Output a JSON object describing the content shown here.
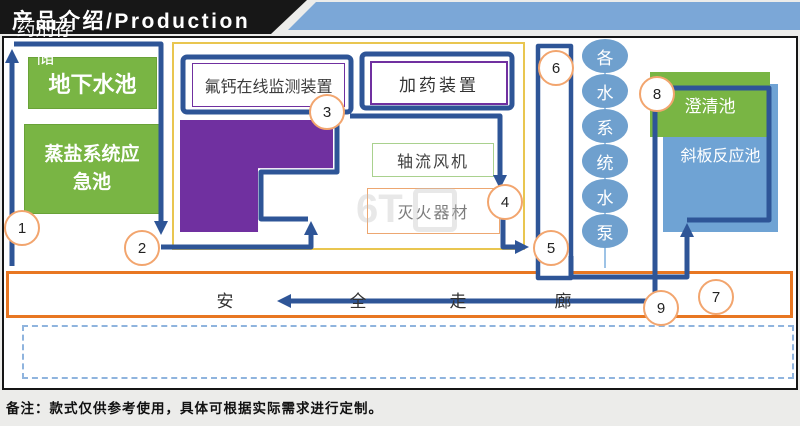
{
  "banner": {
    "title": "产品介绍/Production"
  },
  "boxes": {
    "underground_pool": "地下水池",
    "emergency_pool": "蒸盐系统应急池",
    "monitor": "氟钙在线监测装置",
    "storage": "药剂存储",
    "dosing": "加药装置",
    "fan": "轴流风机",
    "fire": "灭火器材",
    "clarifier": "澄清池",
    "incline_reactor": "斜板反应池"
  },
  "pump_column": [
    "各",
    "水",
    "系",
    "统",
    "水",
    "泵"
  ],
  "corridor": [
    "安",
    "全",
    "走",
    "廊"
  ],
  "markers": [
    "1",
    "2",
    "3",
    "4",
    "5",
    "6",
    "7",
    "8",
    "9"
  ],
  "note": "备注：款式仅供参考使用，具体可根据实际需求进行定制。",
  "colors": {
    "path_blue": "#2E5597",
    "green": "#79B544",
    "purple": "#7030A0",
    "gold": "#E9C650",
    "corridor_orange": "#E87722",
    "light_blue": "#6FA0CE",
    "banner_blue": "#7BA7D7"
  }
}
